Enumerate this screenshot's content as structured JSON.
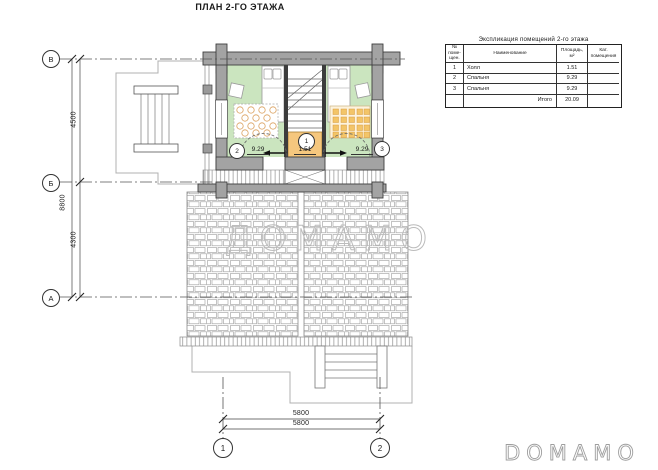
{
  "page": {
    "title": "ПЛАН 2-ГО ЭТАЖА"
  },
  "explication": {
    "title": "Экспликация помещений 2-го этажа",
    "columns": {
      "num": "№\nпоме-\nщен.",
      "name": "Наименование",
      "area": "Площадь,\nм²",
      "cat": "Кат.\nпомещения"
    },
    "rows": [
      {
        "num": "1",
        "name": "Холл",
        "area": "1.51"
      },
      {
        "num": "2",
        "name": "Спальня",
        "area": "9.29"
      },
      {
        "num": "3",
        "name": "Спальня",
        "area": "9.29"
      }
    ],
    "total_label": "Итого",
    "total_area": "20.09"
  },
  "plan": {
    "rooms": [
      {
        "number": "1",
        "area": "1.51"
      },
      {
        "number": "2",
        "area": "9.29"
      },
      {
        "number": "3",
        "area": "9.29"
      }
    ],
    "axes": {
      "left": [
        "В",
        "Б",
        "А"
      ],
      "bottom": [
        "1",
        "2"
      ]
    },
    "dimensions": {
      "left_inner": [
        "4500",
        "4300"
      ],
      "left_outer": "8800",
      "bottom": [
        "5800",
        "5800"
      ]
    }
  },
  "watermark": {
    "center": "ДОМАМО",
    "corner": "DOMAMO"
  },
  "colors": {
    "wall": "#a3a3a3",
    "floor": "#cbe5bf",
    "landing": "#f5c77e",
    "rug_accent": "#f3c568"
  }
}
